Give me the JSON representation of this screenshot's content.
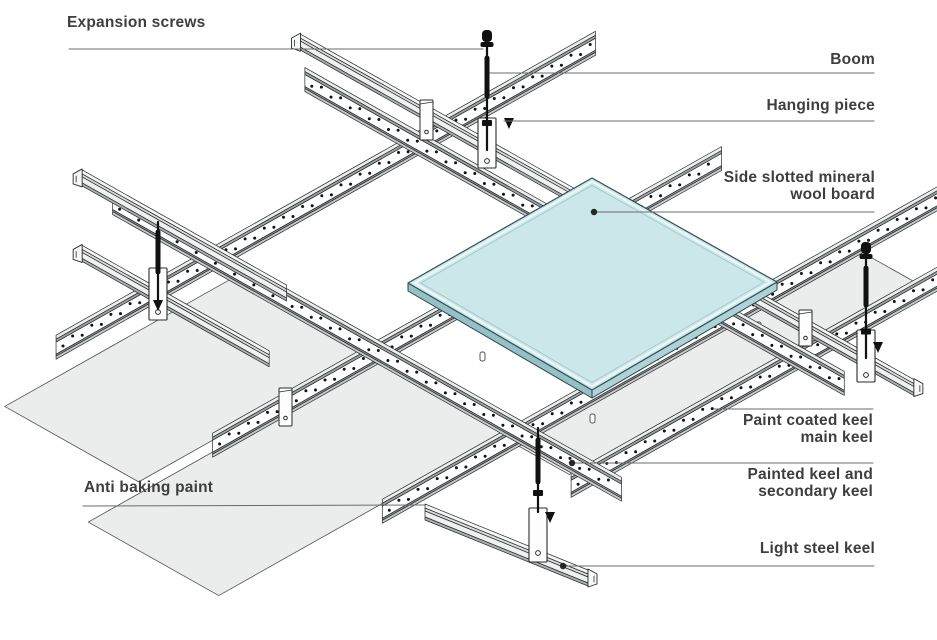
{
  "diagram": {
    "type": "isometric-exploded-assembly",
    "subject": "suspended mineral wool board ceiling keel system",
    "labels": [
      {
        "id": "expansion-screws",
        "text": "Expansion screws"
      },
      {
        "id": "boom",
        "text": "Boom"
      },
      {
        "id": "hanging-piece",
        "text": "Hanging piece"
      },
      {
        "id": "side-slotted-mineral-wool-board",
        "text": "Side slotted mineral\nwool board"
      },
      {
        "id": "paint-coated-keel-main-keel",
        "text": "Paint coated keel\nmain keel"
      },
      {
        "id": "painted-keel-and-secondary-keel",
        "text": "Painted keel and\nsecondary keel"
      },
      {
        "id": "light-steel-keel",
        "text": "Light steel keel"
      },
      {
        "id": "anti-baking-paint",
        "text": "Anti baking paint"
      }
    ],
    "colors": {
      "background": "#ffffff",
      "label_text": "#3e3e3e",
      "leader_line": "#6b6b6b",
      "leader_dot": "#262626",
      "outline": "#2b2b2b",
      "board_top": "#cbe7ea",
      "board_side_dark": "#97c0c6",
      "board_side_light": "#aed2d6",
      "panel_fill": "#ebecec",
      "keel_web": "#ffffff",
      "metal_light": "#eceeee",
      "metal_mid": "#c6cacc",
      "metal_dark": "#9aa1a5",
      "hardware": "#111111"
    }
  }
}
